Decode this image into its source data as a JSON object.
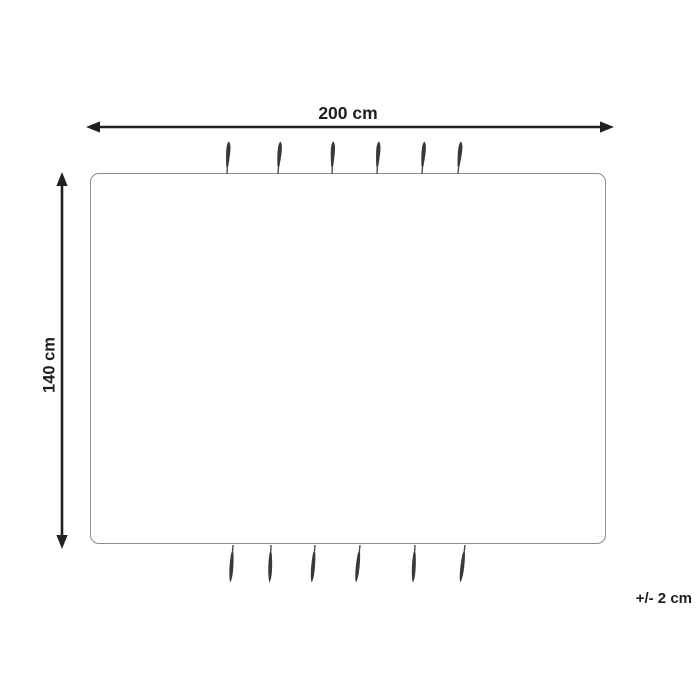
{
  "diagram": {
    "type": "product-dimension-diagram",
    "subject": "rectangular blanket with tassels",
    "width_label": "200 cm",
    "height_label": "140 cm",
    "tolerance_label": "+/- 2 cm",
    "colors": {
      "line": "#211f20",
      "text": "#1f1d1e",
      "outline": "#8c8c8c",
      "tassel": "#3a383a",
      "background": "#ffffff"
    },
    "tassels": {
      "top_x": [
        227,
        278,
        332,
        377,
        422,
        458
      ],
      "top_tilt": [
        3,
        4,
        2,
        3,
        4,
        5
      ],
      "bottom_x": [
        233,
        271,
        315,
        360,
        415,
        465
      ],
      "bottom_tilt": [
        4,
        2,
        5,
        6,
        3,
        7
      ]
    }
  }
}
